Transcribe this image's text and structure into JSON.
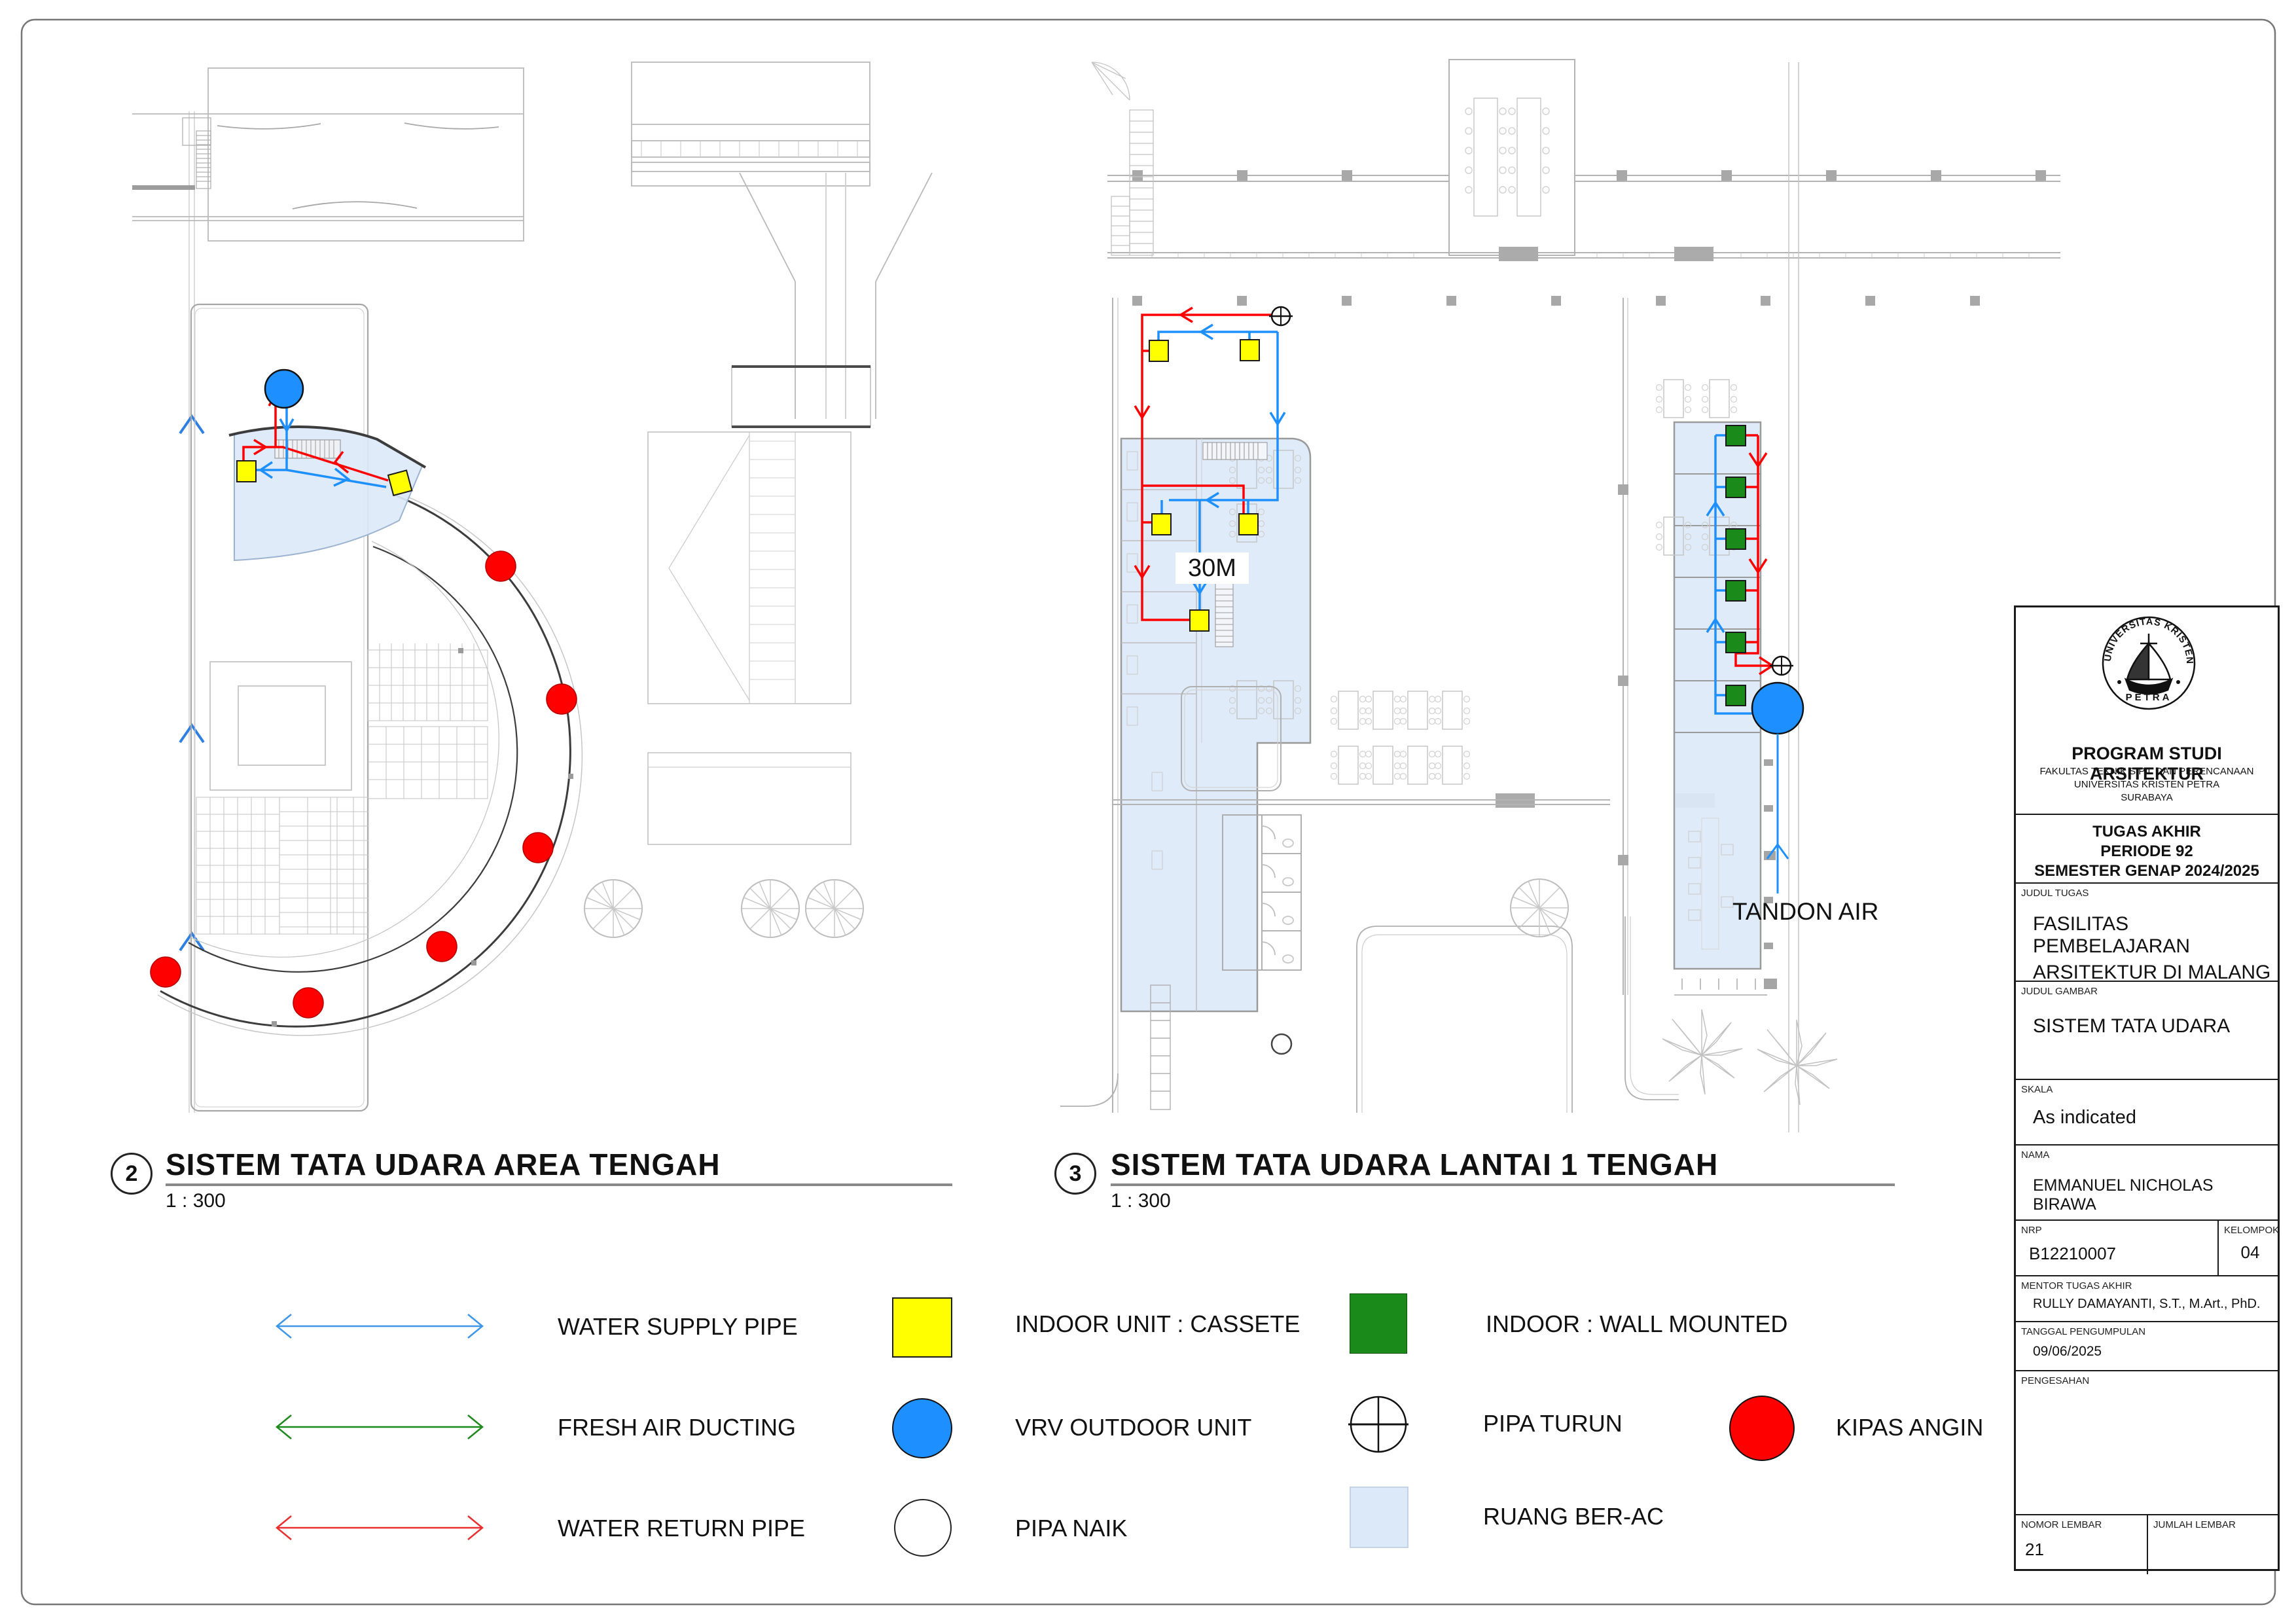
{
  "sheet": {
    "border_color": "#777777",
    "paper": "A1 landscape drawing sheet"
  },
  "drawings": [
    {
      "number": "2",
      "title": "SISTEM TATA UDARA AREA TENGAH",
      "scale": "1 : 300"
    },
    {
      "number": "3",
      "title": "SISTEM TATA UDARA LANTAI 1 TENGAH",
      "scale": "1 : 300"
    }
  ],
  "annotations": {
    "distance": "30M",
    "water_tank": "TANDON AIR"
  },
  "legend": {
    "items": [
      {
        "symbol": "double-arrow",
        "color": "#3E96E8",
        "label": "WATER SUPPLY PIPE"
      },
      {
        "symbol": "double-arrow",
        "color": "#1E8A1E",
        "label": "FRESH AIR DUCTING"
      },
      {
        "symbol": "double-arrow",
        "color": "#E83030",
        "label": "WATER RETURN PIPE"
      },
      {
        "symbol": "yellow-square",
        "color": "#FFFF00",
        "label": "INDOOR UNIT : CASSETE"
      },
      {
        "symbol": "blue-circle",
        "color": "#1E8FFF",
        "label": "VRV OUTDOOR UNIT"
      },
      {
        "symbol": "white-circle",
        "color": "#FFFFFF",
        "label": "PIPA NAIK"
      },
      {
        "symbol": "green-square",
        "color": "#1A8A1A",
        "label": "INDOOR : WALL MOUNTED"
      },
      {
        "symbol": "circle-cross",
        "color": "#111111",
        "label": "PIPA TURUN"
      },
      {
        "symbol": "lightblue-square",
        "color": "#DCE9F8",
        "label": "RUANG BER-AC"
      },
      {
        "symbol": "red-circle",
        "color": "#FF0000",
        "label": "KIPAS ANGIN"
      }
    ]
  },
  "logo": {
    "arc_text": "UNIVERSITAS KRISTEN",
    "bottom_text": "PETRA"
  },
  "title_block": {
    "program": "PROGRAM STUDI ARSITEKTUR",
    "fakultas": "FAKULTAS TEKNIK SIPIL DAN PERENCANAAN",
    "universitas": "UNIVERSITAS KRISTEN PETRA",
    "kota": "SURABAYA",
    "tugas_line1": "TUGAS AKHIR",
    "tugas_line2": "PERIODE 92",
    "tugas_line3": "SEMESTER GENAP 2024/2025",
    "judul_tugas_label": "JUDUL TUGAS",
    "judul_tugas_line1": "FASILITAS PEMBELAJARAN",
    "judul_tugas_line2": "ARSITEKTUR DI MALANG",
    "judul_gambar_label": "JUDUL GAMBAR",
    "judul_gambar": "SISTEM TATA UDARA",
    "skala_label": "SKALA",
    "skala": "As indicated",
    "nama_label": "NAMA",
    "nama": "EMMANUEL NICHOLAS BIRAWA",
    "nrp_label": "NRP",
    "nrp": "B12210007",
    "kelompok_label": "KELOMPOK",
    "kelompok": "04",
    "mentor_label": "MENTOR TUGAS AKHIR",
    "mentor": "RULLY DAMAYANTI, S.T., M.Art., PhD.",
    "tanggal_label": "TANGGAL PENGUMPULAN",
    "tanggal": "09/06/2025",
    "pengesahan_label": "PENGESAHAN",
    "nomor_label": "NOMOR LEMBAR",
    "nomor": "21",
    "jumlah_label": "JUMLAH LEMBAR"
  },
  "colors": {
    "supply_pipe": "#1E8FFF",
    "return_pipe": "#FF0000",
    "fresh_air": "#1E8A1E",
    "room_ac_fill": "#DCE9F8",
    "context_gray": "#B9B9B9"
  }
}
